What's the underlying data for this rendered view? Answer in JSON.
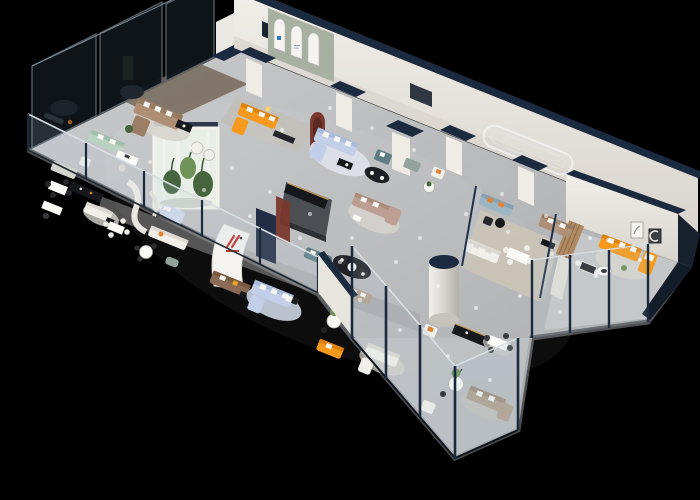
{
  "meta": {
    "title": "3D isometric cutaway render of a furniture showroom floor plan",
    "canvas_width": 700,
    "canvas_height": 500,
    "view": "isometric birds-eye, roof removed, black background"
  },
  "palette": {
    "background": "#000000",
    "floor_main": "#bdbec0",
    "floor_walkway": "#9fa0a2",
    "floor_wood": "#77685a",
    "floor_wood_pale": "#cdc5b6",
    "rug_light": "#d7d4cd",
    "rug_blue": "#ccd5e1",
    "wall_white": "#eae8e2",
    "wall_shade": "#d8d4cd",
    "wall_cap_navy": "#1c2a40",
    "exterior_navy": "#18222f",
    "navy_panel": "#222d45",
    "charcoal_wall": "#4b4f53",
    "sage_wall": "#a8b0a2",
    "arch_white": "#f5f4f0",
    "maroon": "#7a382f",
    "maroon_dark": "#5c2922",
    "glass_dark": "#10161b",
    "glass_frame": "#5a6871",
    "glass_light": "#bcd3de",
    "glass_rail_light": "#d7dee2",
    "sofa_orange": "#f6991c",
    "sofa_mint": "#b9d2c2",
    "sofa_tan": "#ae8e75",
    "sofa_rose": "#bd9e92",
    "sofa_periwinkle": "#c3cfe8",
    "sofa_brown": "#8a6a55",
    "sofa_teal": "#9db6c4",
    "sofa_slate": "#5f7d85",
    "sofa_sage": "#93a39b",
    "sofa_taupe": "#b3a18f",
    "sofa_white": "#f0efea",
    "pillow_white": "#f7f6f2",
    "pillow_orange": "#e2812e",
    "furn_black": "#17181c",
    "gold_trim": "#c89a4a",
    "table_white": "#fbfaf7",
    "plant_green": "#46653f",
    "plant_green_light": "#6e9258",
    "cylinder_white": "#edebe6",
    "logo_red": "#c23028",
    "logo_blue": "#2f7ab8",
    "lamp_glow": "#ffd36b",
    "light_dot": "#ffffff"
  },
  "scene": {
    "description": "Long rectangular showroom slab viewed isometrically. Smoked-glass offices along the upper-left edge, white walls with dark navy caps along the back, an arched display niche room with an orange corner sofa, a central curved white wall with a red brand mark, a glass botanical display box, a white cylindrical column, many sofa and dining vignettes, and a glass balustrade plus tall glass facade along the front cut edge. No legible text anywhere; brand marks are tiny glyphs.",
    "structures": [
      {
        "id": "floor-slab",
        "color": "floor_main"
      },
      {
        "id": "smoked-glass-office-wall",
        "color": "glass_dark"
      },
      {
        "id": "back-wall",
        "color": "wall_white",
        "cap": "wall_cap_navy"
      },
      {
        "id": "arch-niche-room",
        "color": "sage_wall",
        "arches": 3,
        "logo": "logo_blue"
      },
      {
        "id": "maroon-arch-niche",
        "color": "maroon"
      },
      {
        "id": "stadium-wall-moulding",
        "color": "arch_white"
      },
      {
        "id": "glass-plant-box",
        "plants": "plant_green"
      },
      {
        "id": "curved-logo-wall",
        "logo": "logo_red"
      },
      {
        "id": "navy-feature-panel",
        "color": "navy_panel"
      },
      {
        "id": "charcoal-tv-wall",
        "color": "charcoal_wall"
      },
      {
        "id": "white-cylinder-column",
        "color": "cylinder_white",
        "cap": "wall_cap_navy"
      },
      {
        "id": "right-wing-room",
        "exterior": "exterior_navy"
      },
      {
        "id": "front-glass-balustrade",
        "color": "glass_light"
      },
      {
        "id": "front-glass-facade",
        "color": "glass_light"
      }
    ],
    "furniture": [
      {
        "id": "tan-sectional-topleft",
        "kind": "sectional-sofa",
        "color": "sofa_tan"
      },
      {
        "id": "mint-sofa",
        "kind": "sofa",
        "color": "sofa_mint"
      },
      {
        "id": "white-barrel-chairs",
        "kind": "armchairs",
        "color": "sofa_white"
      },
      {
        "id": "desk-set-upper-left",
        "kind": "desk",
        "color": "table_white"
      },
      {
        "id": "gray-sofa-nook",
        "kind": "sofa",
        "color": "rug_light"
      },
      {
        "id": "dark-chair-dining-left",
        "kind": "dining-set",
        "color": "furn_black"
      },
      {
        "id": "black-sideboard-left",
        "kind": "sideboard",
        "color": "furn_black"
      },
      {
        "id": "white-sofa-left",
        "kind": "sofa",
        "color": "sofa_white"
      },
      {
        "id": "white-dining-left",
        "kind": "dining-set",
        "color": "table_white"
      },
      {
        "id": "desk-set-lower-left",
        "kind": "desk",
        "color": "table_white"
      },
      {
        "id": "curved-white-partition",
        "kind": "partition",
        "color": "arch_white"
      },
      {
        "id": "light-blue-daybed",
        "kind": "daybed",
        "color": "sofa_periwinkle"
      },
      {
        "id": "long-white-sofa-left",
        "kind": "sofa",
        "color": "sofa_white"
      },
      {
        "id": "round-dining-left",
        "kind": "dining-set",
        "color": "table_white"
      },
      {
        "id": "teal-pouf",
        "kind": "ottoman",
        "color": "sofa_sage"
      },
      {
        "id": "orange-sofa-arch-room",
        "kind": "corner-sofa",
        "color": "sofa_orange"
      },
      {
        "id": "periwinkle-sectional-upper",
        "kind": "sectional-sofa",
        "color": "sofa_periwinkle"
      },
      {
        "id": "teal-loveseat",
        "kind": "loveseat",
        "color": "sofa_slate"
      },
      {
        "id": "sage-loveseat",
        "kind": "loveseat",
        "color": "sofa_sage"
      },
      {
        "id": "black-rug-lounge-a",
        "kind": "lounge-chairs",
        "color": "furn_black"
      },
      {
        "id": "rose-corner-sofa",
        "kind": "corner-sofa",
        "color": "sofa_rose"
      },
      {
        "id": "black-rug-lounge-b",
        "kind": "lounge-chairs",
        "color": "furn_black"
      },
      {
        "id": "slate-sofa-center",
        "kind": "sofa",
        "color": "sofa_slate"
      },
      {
        "id": "brown-leather-sofa",
        "kind": "sofa",
        "color": "sofa_brown"
      },
      {
        "id": "periwinkle-sectional-lower",
        "kind": "sectional-sofa",
        "color": "sofa_periwinkle"
      },
      {
        "id": "taupe-sofa-center",
        "kind": "sofa",
        "color": "sofa_taupe"
      },
      {
        "id": "plant-pedestal-table",
        "kind": "side-table",
        "color": "table_white"
      },
      {
        "id": "orange-sofa-front",
        "kind": "sofa",
        "color": "sofa_orange"
      },
      {
        "id": "white-corner-sofa-front",
        "kind": "corner-sofa",
        "color": "sofa_white"
      },
      {
        "id": "armchair-orange-pillow",
        "kind": "armchair",
        "color": "sofa_white"
      },
      {
        "id": "black-gold-console",
        "kind": "sideboard",
        "color": "furn_black"
      },
      {
        "id": "dining-set-front",
        "kind": "dining-set",
        "color": "table_white"
      },
      {
        "id": "pedestal-table-plant-front",
        "kind": "side-table",
        "color": "table_white"
      },
      {
        "id": "white-armchair-front",
        "kind": "armchair",
        "color": "sofa_white"
      },
      {
        "id": "taupe-corner-sofa-front",
        "kind": "corner-sofa",
        "color": "sofa_taupe"
      },
      {
        "id": "teal-sofa-right",
        "kind": "sofa",
        "color": "sofa_teal"
      },
      {
        "id": "tan-sofa-right",
        "kind": "sofa",
        "color": "sofa_tan"
      },
      {
        "id": "nook-armchair-right",
        "kind": "armchair",
        "color": "sofa_white"
      },
      {
        "id": "white-sofa-by-cylinder",
        "kind": "sofa",
        "color": "sofa_white"
      },
      {
        "id": "dining-set-right",
        "kind": "dining-set",
        "color": "table_white"
      },
      {
        "id": "bw-dining-set",
        "kind": "dining-set",
        "color": "furn_black"
      },
      {
        "id": "orange-corner-sofa-wing",
        "kind": "corner-sofa",
        "color": "sofa_orange"
      },
      {
        "id": "wing-coffee-table",
        "kind": "coffee-table",
        "color": "table_white"
      },
      {
        "id": "wing-wall-art-light",
        "kind": "picture-frame",
        "color": "arch_white"
      },
      {
        "id": "wing-wall-art-dark",
        "kind": "picture-frame",
        "color": "charcoal_wall"
      }
    ],
    "signage": [
      {
        "id": "red-brand-mark",
        "style": "angled red strokes with red bar, tiny illegible caption",
        "color": "logo_red"
      },
      {
        "id": "blue-arch-logo",
        "style": "small square mark on arched panel",
        "color": "logo_blue"
      },
      {
        "id": "crescent-art-glyph",
        "style": "white crescent in dark frame",
        "color": "arch_white"
      }
    ]
  }
}
